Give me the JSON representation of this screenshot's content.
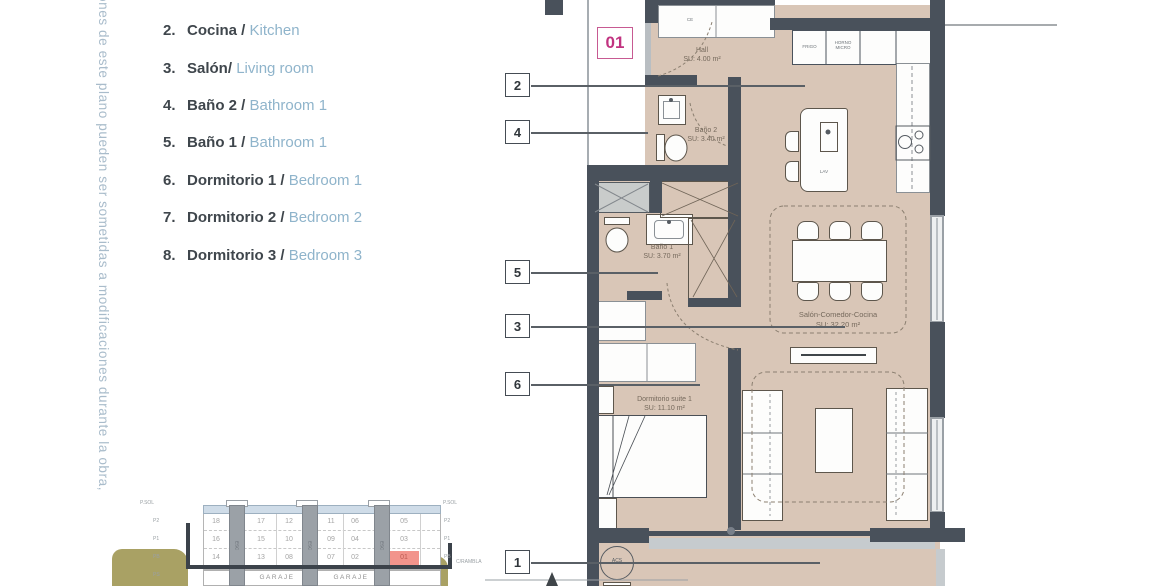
{
  "disclaimer": {
    "text": "ones de este plano pueden ser sometidas a modificaciones durante la obra,"
  },
  "legend": {
    "items": [
      {
        "num": "2.",
        "es": "Cocina / ",
        "en": "Kitchen"
      },
      {
        "num": "3.",
        "es": "Salón/ ",
        "en": "Living room"
      },
      {
        "num": "4.",
        "es": "Baño 2 / ",
        "en": "Bathroom 1"
      },
      {
        "num": "5.",
        "es": "Baño 1 / ",
        "en": "Bathroom 1"
      },
      {
        "num": "6.",
        "es": "Dormitorio 1 / ",
        "en": "Bedroom 1"
      },
      {
        "num": "7.",
        "es": "Dormitorio 2 / ",
        "en": "Bedroom 2"
      },
      {
        "num": "8.",
        "es": "Dormitorio 3 / ",
        "en": "Bedroom 3"
      }
    ]
  },
  "plan": {
    "unit_badge": "01",
    "callouts": [
      {
        "num": "2"
      },
      {
        "num": "4"
      },
      {
        "num": "5"
      },
      {
        "num": "3"
      },
      {
        "num": "6"
      },
      {
        "num": "1"
      }
    ],
    "rooms": {
      "hall": {
        "name": "Hall",
        "area": "SU: 4.00 m²"
      },
      "bano2": {
        "name": "Baño 2",
        "area": "SU: 3.40 m²"
      },
      "bano1": {
        "name": "Baño 1",
        "area": "SU: 3.70 m²"
      },
      "salon": {
        "name": "Salón-Comedor-Cocina",
        "area": "SU: 32.20 m²"
      },
      "dormitorio": {
        "name": "Dormitorio suite 1",
        "area": "SU: 11.10 m²"
      }
    },
    "labels": {
      "fridge": "FRIGO",
      "oven": "HORNO MICRO",
      "island_sink": "LAV",
      "boiler": "ACS",
      "entry_closet": "CE"
    }
  },
  "section": {
    "top_left_label": "P.SOL",
    "top_right_label": "P.SOL",
    "floor_labels_left": [
      "P2",
      "P1",
      "PB",
      "PS"
    ],
    "floor_labels_right": [
      "P2",
      "P1",
      "PB"
    ],
    "street_label": "C/RAMBLA",
    "garage_label_1": "GARAJE",
    "garage_label_2": "GARAJE",
    "stair_label": "ESC",
    "rows": [
      [
        "18",
        "17",
        "12",
        "11",
        "06",
        "05"
      ],
      [
        "16",
        "15",
        "10",
        "09",
        "04",
        "03"
      ],
      [
        "14",
        "13",
        "08",
        "07",
        "02",
        "01"
      ]
    ],
    "highlighted_unit": "01"
  },
  "colors": {
    "accent_pink": "#c13380",
    "highlight_unit": "#f2948c",
    "wall": "#49515b",
    "floor": "#d9c6b7",
    "legend_blue": "#8fb4cb",
    "olive": "#a9a164"
  }
}
